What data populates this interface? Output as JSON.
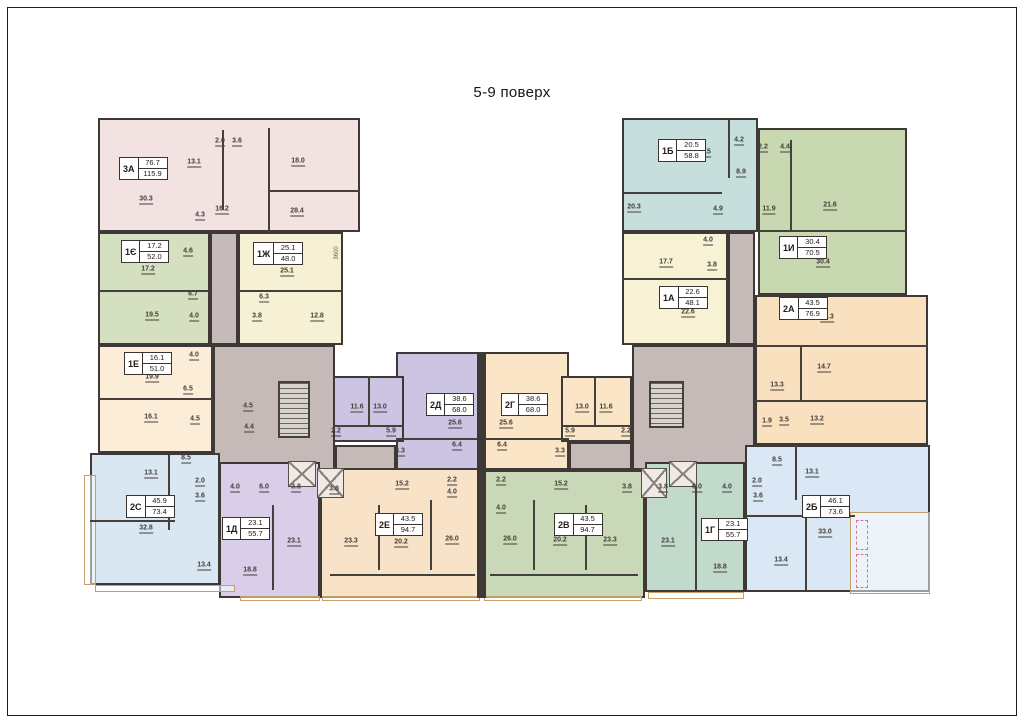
{
  "title": "5-9 поверх",
  "colors": {
    "wall": "#3e3836",
    "corridor": "#c6bab8",
    "balcony_border": "#c59e6a",
    "text": "#443e3a"
  },
  "corridor": {
    "blocks": [
      [
        210,
        232,
        28,
        113
      ],
      [
        213,
        345,
        122,
        125
      ],
      [
        335,
        445,
        61,
        25
      ],
      [
        728,
        232,
        27,
        113
      ],
      [
        632,
        345,
        123,
        125
      ],
      [
        569,
        442,
        63,
        28
      ]
    ],
    "rooms": [
      [
        "4.5",
        248,
        407
      ],
      [
        "4.4",
        249,
        428
      ]
    ]
  },
  "apartments": [
    {
      "id": "3a",
      "code": "3А",
      "living": "76.7",
      "total": "115.9",
      "color": "#f3e2e2",
      "blocks": [
        [
          98,
          118,
          262,
          114
        ]
      ],
      "label": [
        119,
        157
      ],
      "rooms": [
        [
          "30.3",
          146,
          200
        ],
        [
          "13.1",
          194,
          163
        ],
        [
          "2.0",
          220,
          142
        ],
        [
          "3.6",
          237,
          142
        ],
        [
          "18.0",
          298,
          162
        ],
        [
          "16.2",
          222,
          210
        ],
        [
          "4.3",
          200,
          216
        ],
        [
          "28.4",
          297,
          212
        ]
      ]
    },
    {
      "id": "1ye",
      "code": "1Є",
      "living": "17.2",
      "total": "52.0",
      "color": "#d4e0bf",
      "blocks": [
        [
          98,
          232,
          112,
          113
        ]
      ],
      "label": [
        121,
        240
      ],
      "rooms": [
        [
          "17.2",
          148,
          270
        ],
        [
          "4.6",
          188,
          252
        ],
        [
          "6.7",
          193,
          295
        ],
        [
          "19.5",
          152,
          316
        ],
        [
          "4.0",
          194,
          317
        ]
      ]
    },
    {
      "id": "1zh",
      "code": "1Ж",
      "living": "25.1",
      "total": "48.0",
      "color": "#f6f0d4",
      "blocks": [
        [
          238,
          232,
          105,
          113
        ]
      ],
      "label": [
        253,
        242
      ],
      "rooms": [
        [
          "25.1",
          287,
          272
        ],
        [
          "6.3",
          264,
          298
        ],
        [
          "3.8",
          257,
          317
        ],
        [
          "12.8",
          317,
          317
        ]
      ]
    },
    {
      "id": "1e",
      "code": "1Е",
      "living": "16.1",
      "total": "51.0",
      "color": "#fcedd9",
      "blocks": [
        [
          98,
          345,
          115,
          108
        ]
      ],
      "label": [
        124,
        352
      ],
      "rooms": [
        [
          "4.0",
          194,
          356
        ],
        [
          "19.9",
          152,
          378
        ],
        [
          "6.5",
          188,
          390
        ],
        [
          "16.1",
          151,
          418
        ],
        [
          "4.5",
          195,
          420
        ]
      ]
    },
    {
      "id": "2s",
      "code": "2С",
      "living": "45.9",
      "total": "73.4",
      "color": "#d9e7f3",
      "blocks": [
        [
          90,
          453,
          130,
          132
        ]
      ],
      "label": [
        126,
        495
      ],
      "rooms": [
        [
          "8.5",
          186,
          459
        ],
        [
          "13.1",
          151,
          474
        ],
        [
          "2.0",
          200,
          482
        ],
        [
          "3.6",
          200,
          497
        ],
        [
          "32.8",
          146,
          529
        ],
        [
          "13.4",
          204,
          566
        ]
      ]
    },
    {
      "id": "1d",
      "code": "1Д",
      "living": "23.1",
      "total": "55.7",
      "color": "#d9cee8",
      "blocks": [
        [
          219,
          462,
          101,
          136
        ]
      ],
      "label": [
        222,
        517
      ],
      "rooms": [
        [
          "4.0",
          235,
          488
        ],
        [
          "6.0",
          264,
          488
        ],
        [
          "3.8",
          296,
          488
        ],
        [
          "23.1",
          294,
          542
        ],
        [
          "18.8",
          250,
          571
        ]
      ]
    },
    {
      "id": "2e",
      "code": "2Е",
      "living": "43.5",
      "total": "94.7",
      "color": "#f8e3c9",
      "blocks": [
        [
          320,
          468,
          162,
          130
        ]
      ],
      "label": [
        375,
        513
      ],
      "rooms": [
        [
          "3.8",
          334,
          490
        ],
        [
          "15.2",
          402,
          485
        ],
        [
          "2.2",
          452,
          481
        ],
        [
          "4.0",
          452,
          493
        ],
        [
          "23.3",
          351,
          542
        ],
        [
          "20.2",
          401,
          543
        ],
        [
          "26.0",
          452,
          540
        ]
      ]
    },
    {
      "id": "2d",
      "code": "2Д",
      "living": "38.6",
      "total": "68.0",
      "color": "#cbc5e3",
      "blocks": [
        [
          396,
          352,
          86,
          118
        ],
        [
          333,
          376,
          71,
          66
        ]
      ],
      "label": [
        426,
        393
      ],
      "rooms": [
        [
          "11.6",
          357,
          408
        ],
        [
          "13.0",
          380,
          408
        ],
        [
          "2.2",
          336,
          432
        ],
        [
          "5.9",
          391,
          432
        ],
        [
          "25.6",
          455,
          424
        ],
        [
          "3.3",
          400,
          452
        ],
        [
          "6.4",
          457,
          446
        ]
      ]
    },
    {
      "id": "2g",
      "code": "2Г",
      "living": "38.6",
      "total": "68.0",
      "color": "#fae5c6",
      "blocks": [
        [
          483,
          352,
          86,
          118
        ],
        [
          561,
          376,
          71,
          66
        ]
      ],
      "label": [
        501,
        393
      ],
      "rooms": [
        [
          "25.6",
          506,
          424
        ],
        [
          "13.0",
          582,
          408
        ],
        [
          "11.6",
          606,
          408
        ],
        [
          "5.9",
          570,
          432
        ],
        [
          "2.2",
          626,
          432
        ],
        [
          "6.4",
          502,
          446
        ],
        [
          "3.3",
          560,
          452
        ]
      ]
    },
    {
      "id": "2v",
      "code": "2В",
      "living": "43.5",
      "total": "94.7",
      "color": "#c9d9b7",
      "blocks": [
        [
          483,
          470,
          162,
          128
        ]
      ],
      "label": [
        554,
        513
      ],
      "rooms": [
        [
          "2.2",
          501,
          481
        ],
        [
          "15.2",
          561,
          485
        ],
        [
          "4.0",
          501,
          509
        ],
        [
          "3.8",
          627,
          488
        ],
        [
          "26.0",
          510,
          540
        ],
        [
          "20.2",
          560,
          541
        ],
        [
          "23.3",
          610,
          541
        ]
      ]
    },
    {
      "id": "1g",
      "code": "1Г",
      "living": "23.1",
      "total": "55.7",
      "color": "#c1dacc",
      "blocks": [
        [
          645,
          462,
          100,
          130
        ]
      ],
      "label": [
        701,
        518
      ],
      "rooms": [
        [
          "3.8",
          663,
          488
        ],
        [
          "6.0",
          697,
          488
        ],
        [
          "4.0",
          727,
          488
        ],
        [
          "23.1",
          668,
          542
        ],
        [
          "18.8",
          720,
          568
        ]
      ]
    },
    {
      "id": "2b",
      "code": "2Б",
      "living": "46.1",
      "total": "73.6",
      "color": "#d9e8f4",
      "blocks": [
        [
          745,
          445,
          185,
          147
        ]
      ],
      "label": [
        802,
        495
      ],
      "rooms": [
        [
          "2.0",
          757,
          482
        ],
        [
          "3.6",
          758,
          497
        ],
        [
          "8.5",
          777,
          461
        ],
        [
          "13.1",
          812,
          473
        ],
        [
          "33.0",
          825,
          533
        ],
        [
          "13.4",
          781,
          561
        ]
      ]
    },
    {
      "id": "1b",
      "code": "1Б",
      "living": "20.5",
      "total": "58.8",
      "color": "#c6dfdd",
      "blocks": [
        [
          622,
          118,
          136,
          114
        ]
      ],
      "label": [
        658,
        139
      ],
      "rooms": [
        [
          "20.5",
          704,
          153
        ],
        [
          "4.2",
          739,
          141
        ],
        [
          "8.9",
          741,
          173
        ],
        [
          "20.3",
          634,
          208
        ],
        [
          "4.9",
          718,
          210
        ]
      ]
    },
    {
      "id": "1i",
      "code": "1И",
      "living": "30.4",
      "total": "70.5",
      "color": "#c8d8b0",
      "blocks": [
        [
          758,
          128,
          149,
          167
        ]
      ],
      "label": [
        779,
        236
      ],
      "rooms": [
        [
          "2.2",
          763,
          148
        ],
        [
          "4.4",
          785,
          148
        ],
        [
          "11.9",
          769,
          210
        ],
        [
          "21.6",
          830,
          206
        ],
        [
          "30.4",
          823,
          263
        ]
      ]
    },
    {
      "id": "1a",
      "code": "1А",
      "living": "22.6",
      "total": "48.1",
      "color": "#f8f2d5",
      "blocks": [
        [
          622,
          232,
          106,
          113
        ]
      ],
      "label": [
        659,
        286
      ],
      "rooms": [
        [
          "17.7",
          666,
          263
        ],
        [
          "4.0",
          708,
          241
        ],
        [
          "3.8",
          712,
          266
        ],
        [
          "22.6",
          688,
          313
        ]
      ]
    },
    {
      "id": "2a",
      "code": "2А",
      "living": "43.5",
      "total": "76.9",
      "color": "#f9e1bf",
      "blocks": [
        [
          755,
          295,
          173,
          150
        ]
      ],
      "label": [
        779,
        297
      ],
      "rooms": [
        [
          "30.3",
          827,
          318
        ],
        [
          "14.7",
          824,
          368
        ],
        [
          "13.3",
          777,
          386
        ],
        [
          "1.9",
          767,
          422
        ],
        [
          "3.5",
          784,
          421
        ],
        [
          "13.2",
          817,
          420
        ]
      ]
    }
  ],
  "stairs": [
    [
      278,
      381,
      32,
      57
    ],
    [
      649,
      381,
      35,
      47
    ]
  ],
  "shafts": [
    [
      288,
      461,
      28,
      26
    ],
    [
      317,
      468,
      27,
      30
    ],
    [
      641,
      468,
      26,
      30
    ],
    [
      669,
      461,
      28,
      26
    ]
  ],
  "joints": [
    [
      477,
      352,
      9,
      246
    ]
  ],
  "walls": [
    [
      222,
      130,
      2,
      80
    ],
    [
      268,
      128,
      2,
      104
    ],
    [
      268,
      190,
      92,
      2
    ],
    [
      98,
      290,
      112,
      2
    ],
    [
      98,
      398,
      115,
      2
    ],
    [
      238,
      290,
      105,
      2
    ],
    [
      168,
      455,
      2,
      75
    ],
    [
      90,
      520,
      85,
      2
    ],
    [
      272,
      505,
      2,
      85
    ],
    [
      378,
      505,
      2,
      65
    ],
    [
      430,
      500,
      2,
      70
    ],
    [
      533,
      500,
      2,
      70
    ],
    [
      585,
      505,
      2,
      65
    ],
    [
      695,
      480,
      2,
      110
    ],
    [
      795,
      445,
      2,
      55
    ],
    [
      745,
      515,
      110,
      2
    ],
    [
      805,
      517,
      2,
      73
    ],
    [
      728,
      120,
      2,
      58
    ],
    [
      624,
      192,
      98,
      2
    ],
    [
      758,
      230,
      149,
      2
    ],
    [
      790,
      140,
      2,
      90
    ],
    [
      622,
      278,
      106,
      2
    ],
    [
      755,
      345,
      173,
      2
    ],
    [
      755,
      400,
      173,
      2
    ],
    [
      800,
      347,
      2,
      53
    ],
    [
      396,
      438,
      86,
      2
    ],
    [
      483,
      438,
      86,
      2
    ],
    [
      368,
      376,
      2,
      50
    ],
    [
      594,
      376,
      2,
      50
    ],
    [
      333,
      425,
      71,
      2
    ],
    [
      561,
      425,
      71,
      2
    ],
    [
      330,
      574,
      145,
      2
    ],
    [
      490,
      574,
      148,
      2
    ]
  ],
  "balconies": [
    [
      84,
      475,
      12,
      110
    ],
    [
      95,
      585,
      140,
      7
    ],
    [
      240,
      596,
      80,
      5
    ],
    [
      322,
      596,
      158,
      5
    ],
    [
      484,
      596,
      158,
      5
    ],
    [
      648,
      592,
      96,
      7
    ],
    [
      850,
      512,
      80,
      82
    ]
  ],
  "dashed": [
    [
      856,
      520,
      12,
      30
    ],
    [
      856,
      554,
      12,
      34
    ]
  ],
  "dimension": {
    "text": "3600",
    "x": 337,
    "y": 253
  }
}
